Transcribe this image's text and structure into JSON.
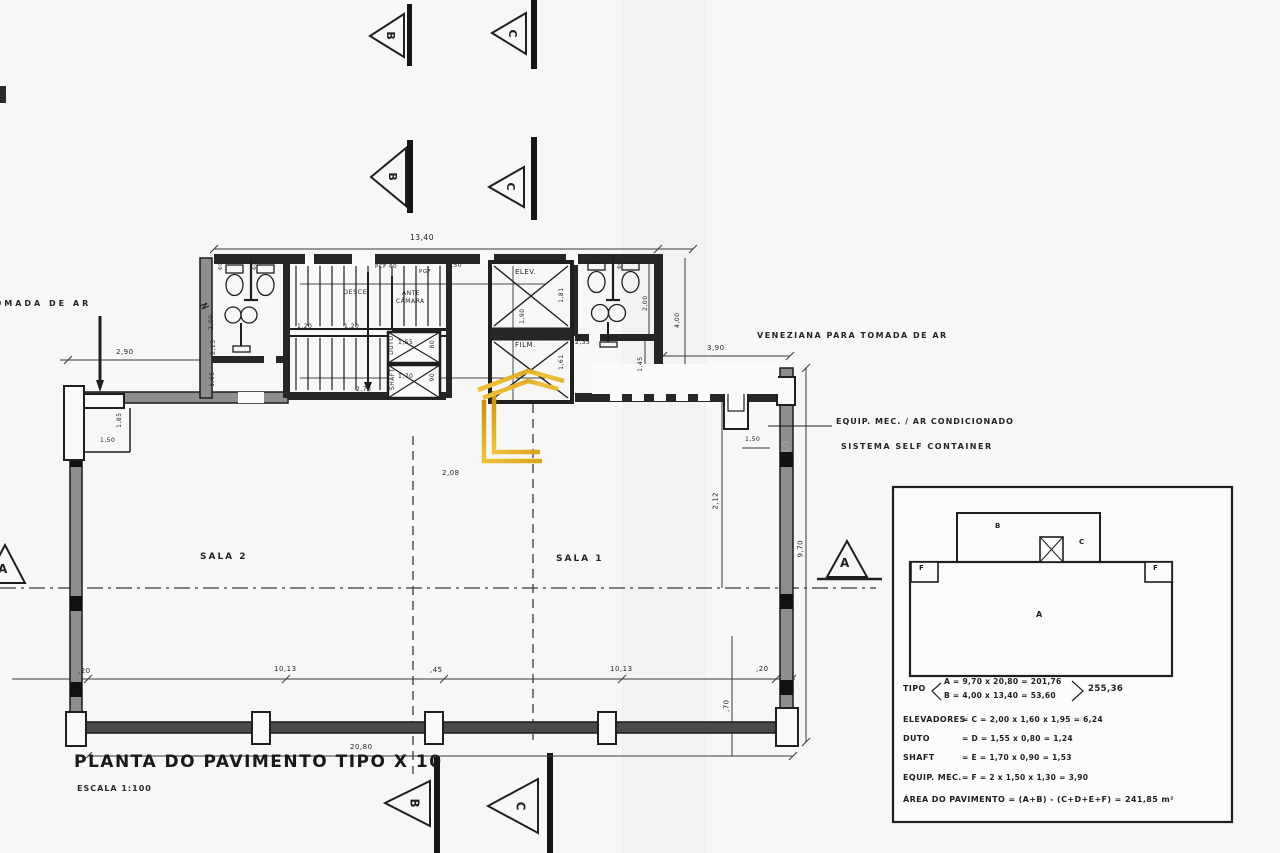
{
  "drawing": {
    "title": "PLANTA DO PAVIMENTO TIPO X 10",
    "scale": "ESCALA 1:100",
    "rooms": {
      "sala1": "SALA 1",
      "sala2": "SALA 2",
      "elev": "ELEV.",
      "film": "FILM.",
      "desce": "DESCE",
      "ante": "ANTE",
      "camara": "CÂMARA",
      "duto": "DUTO",
      "shaft": "SHAFT"
    },
    "doors": {
      "pcf60": "PCF 60",
      "pgf": "PGF"
    },
    "notes": {
      "tomada_de_ar": "TOMADA DE AR",
      "veneziana": "VENEZIANA PARA TOMADA DE AR",
      "equip_mec": "EQUIP. MEC. / AR CONDICIONADO",
      "sistema": "SISTEMA SELF CONTAINER",
      "watermark_remnant": "S"
    },
    "markers": {
      "a": "A",
      "b": "B",
      "c": "C"
    },
    "dims": {
      "top_width": "13,40",
      "door_50": ",50",
      "left_290": "2,90",
      "left_185": "1,85",
      "left_150": "1,50",
      "wall_200": "2,00",
      "wall_215": "2,15",
      "wall_165": "1,65",
      "stair_120a": "1,20",
      "stair_120b": "1,20",
      "stair_270": "2,70",
      "duto_155": "1,55",
      "duto_80": "80",
      "shaft_170": "1,70",
      "shaft_90": "90",
      "elev_181": "1,81",
      "elev_190": "1,90",
      "elev_161": "1,61",
      "elev_235": "2,35",
      "wc_60": "60",
      "right_200": "2,00",
      "right_400": "4,00",
      "right_145": "1,45",
      "right_390": "3,90",
      "right_150": "1,50",
      "mid_208": "2,08",
      "right_212": "2,12",
      "right_970": "9,70",
      "bot_20l": ",20",
      "bot_1013l": "10,13",
      "bot_45": ",45",
      "bot_1013r": "10,13",
      "bot_20r": ",20",
      "bot_2080": "20,80",
      "bot_70": ",70"
    }
  },
  "legend": {
    "diagram": {
      "a": "A",
      "b": "B",
      "c": "C",
      "f": "F"
    },
    "tipo_label": "TIPO",
    "tipo_a": "A = 9,70 x 20,80 = 201,76",
    "tipo_b": "B = 4,00 x 13,40 = 53,60",
    "tipo_total": "255,36",
    "rows": [
      {
        "label": "ELEVADORES",
        "value": "= C = 2,00 x 1,60 x 1,95 = 6,24"
      },
      {
        "label": "DUTO",
        "value": "= D = 1,55 x 0,80 = 1,24"
      },
      {
        "label": "SHAFT",
        "value": "= E = 1,70 x 0,90 = 1,53"
      },
      {
        "label": "EQUIP. MEC.",
        "value": "= F = 2 x 1,50 x 1,30 = 3,90"
      }
    ],
    "area_line": "ÁREA DO PAVIMENTO = (A+B) - (C+D+E+F) = 241,85 m²"
  },
  "colors": {
    "ink": "#1f1f1f",
    "paper": "#fafaf8",
    "wall_gray": "#8e8e8e",
    "watermark_gold": "#d9a41e"
  }
}
